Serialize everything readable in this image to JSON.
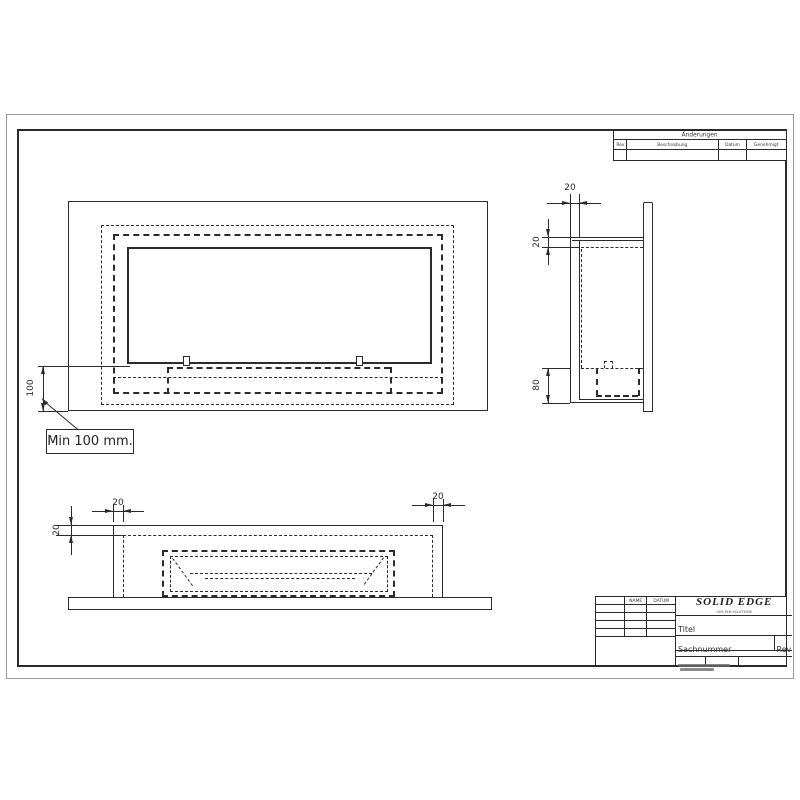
{
  "colors": {
    "ink": "#2b2b2b",
    "paper": "#ffffff"
  },
  "annotations": {
    "min_note": "Min 100 mm."
  },
  "dimensions": {
    "front_offset": "100",
    "side_wall": "20",
    "side_top": "20",
    "side_burner": "80",
    "bottom_wall_left": "20",
    "bottom_top_wall": "20",
    "bottom_wall_right": "20"
  },
  "revision_table": {
    "title": "Änderungen",
    "col_rev": "Rev",
    "col_beschreibung": "Beschreibung",
    "col_datum": "Datum",
    "col_genehmigt": "Genehmigt"
  },
  "title_block": {
    "col_name": "NAME",
    "col_datum": "DATUM",
    "row_drawn": "Gezeichnet",
    "row_checked": "Geprüft",
    "logo_title": "SOLID EDGE",
    "logo_subtitle": "UGS PLM SOLUTIONS",
    "titel_label": "Titel",
    "sachnummer_label": "Sachnummer",
    "rev_label": "Rev",
    "masstab_label": "Maßstab",
    "gewicht_label": "Gewicht",
    "blatt_label": "Blatt 1 von 1"
  }
}
